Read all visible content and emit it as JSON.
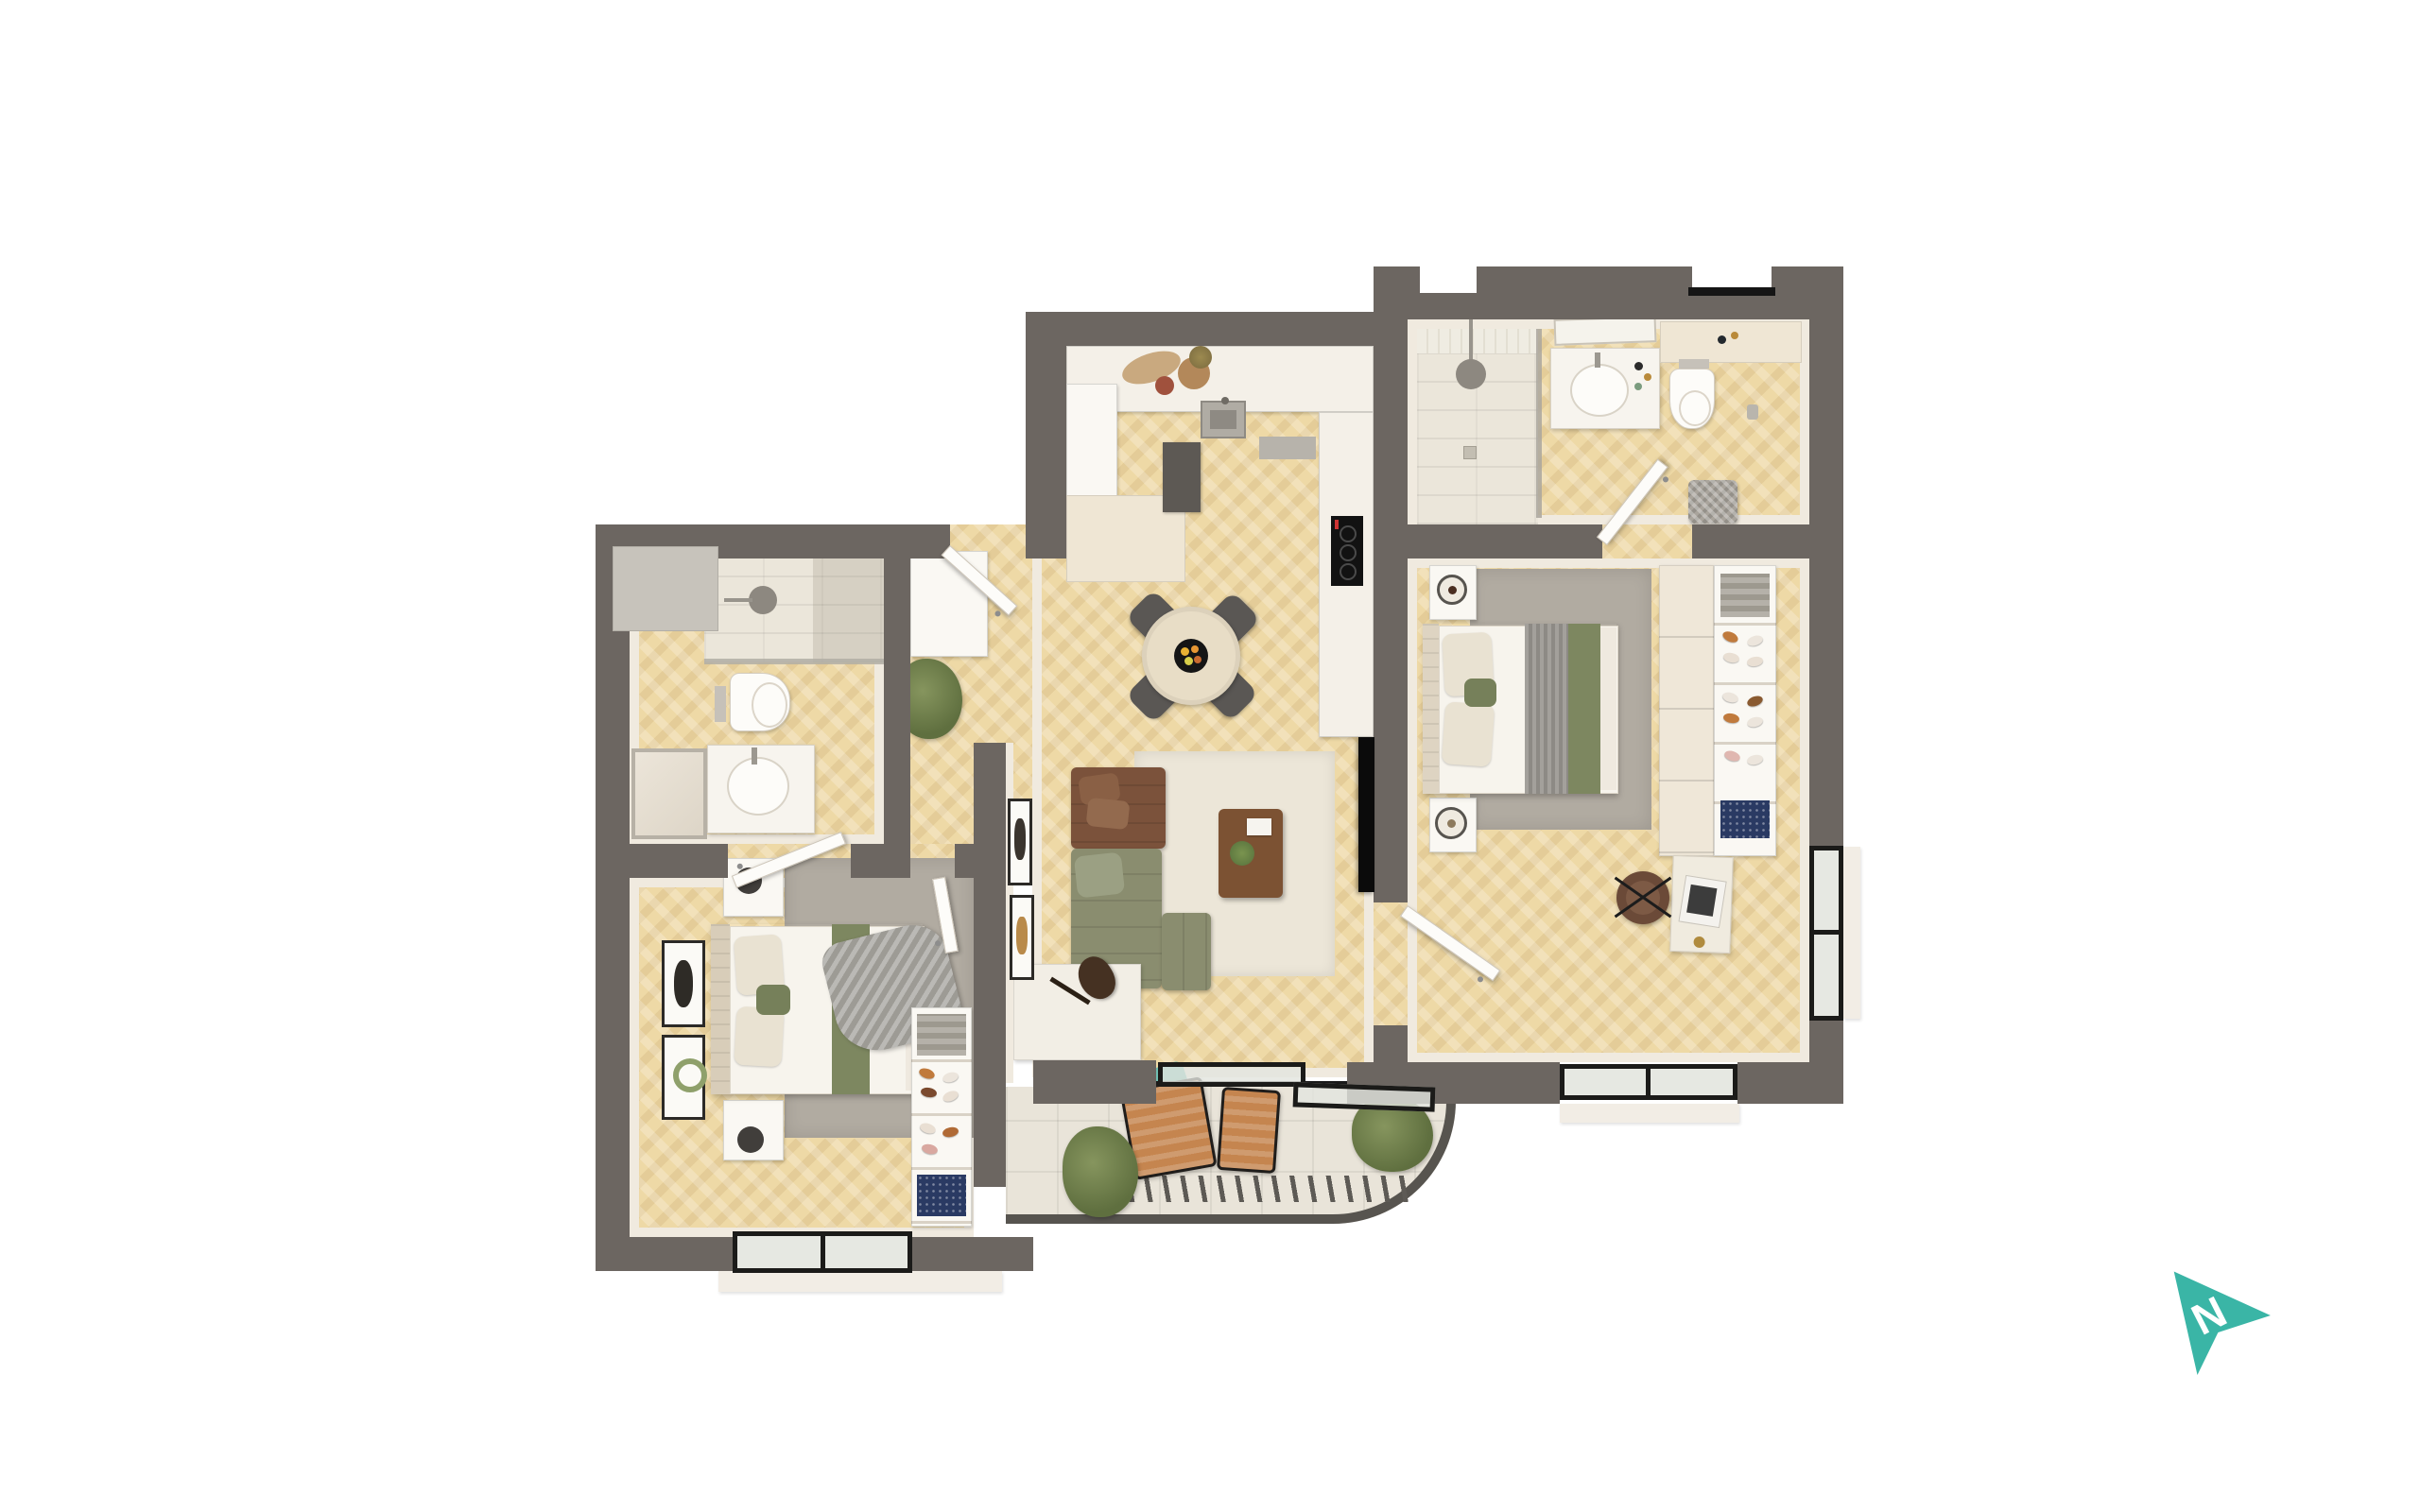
{
  "meta": {
    "description": "3D top-down rendered floor plan of a two-bedroom apartment on a white background",
    "background": "#ffffff"
  },
  "compass": {
    "label": "N",
    "color": "#3ab5a6"
  },
  "palette": {
    "wall": "#6c6661",
    "wall_inner_face": "#f0eadf",
    "wood_floor": "#eed9a6",
    "bathroom_tile": "#ebe6da",
    "balcony_tile": "#e9e4d9",
    "rug_grey": "#b1aba1",
    "rug_cream": "#ece6d8",
    "sofa_green": "#8a8d6f",
    "sofa_brown": "#7b523b",
    "bed_runner_green": "#7d8760",
    "counter_white": "#f4f0e8",
    "cabinet_cream": "#efe6d4",
    "window_frame": "#1b1b19",
    "plant_green": "#6f7d4e",
    "lounger_cork": "#c5854f",
    "coffee_table_wood": "#7c5233",
    "accent_teal": "#3ab5a6"
  },
  "rooms": [
    {
      "id": "kitchen-dining",
      "floor": "wood-herringbone",
      "furniture": [
        "l-shaped-counter",
        "sink",
        "induction-hob",
        "oven",
        "fridge",
        "base-cabinet",
        "round-dining-table",
        "four-chairs",
        "fruit-bowl"
      ]
    },
    {
      "id": "living-room",
      "floor": "wood-herringbone",
      "furniture": [
        "corner-sofa-green",
        "brown-leather-chaise",
        "ottoman",
        "wood-coffee-table",
        "cream-rug",
        "wall-tv",
        "guitar",
        "sideboard-bench",
        "two-art-frames"
      ]
    },
    {
      "id": "hallway",
      "floor": "wood-herringbone",
      "furniture": [
        "entry-door",
        "built-in-closet",
        "potted-plant"
      ]
    },
    {
      "id": "bathroom",
      "floor": "wood-and-tile",
      "furniture": [
        "walk-in-shower",
        "wall-hung-toilet",
        "vanity-basin",
        "leaning-mirror",
        "door"
      ]
    },
    {
      "id": "bedroom-2",
      "floor": "wood-herringbone",
      "furniture": [
        "double-bed",
        "two-nightstands",
        "grey-rug",
        "throw-blanket",
        "two-art-frames",
        "open-shelf-unit-shoes",
        "sliding-window"
      ]
    },
    {
      "id": "en-suite",
      "floor": "wood-and-tile",
      "furniture": [
        "walk-in-shower",
        "vanity-basin",
        "wall-hung-toilet",
        "laundry-basket",
        "door"
      ]
    },
    {
      "id": "bedroom-1",
      "floor": "wood-herringbone",
      "furniture": [
        "double-bed",
        "two-nightstands",
        "grey-rug",
        "wardrobe",
        "open-shoe-shelves",
        "desk-with-laptop",
        "office-chair",
        "corner-windows"
      ]
    },
    {
      "id": "balcony",
      "floor": "stone-tiles",
      "furniture": [
        "two-cork-loungers",
        "teal-cushion",
        "two-planters",
        "curved-railing",
        "sliding-doors"
      ]
    }
  ]
}
